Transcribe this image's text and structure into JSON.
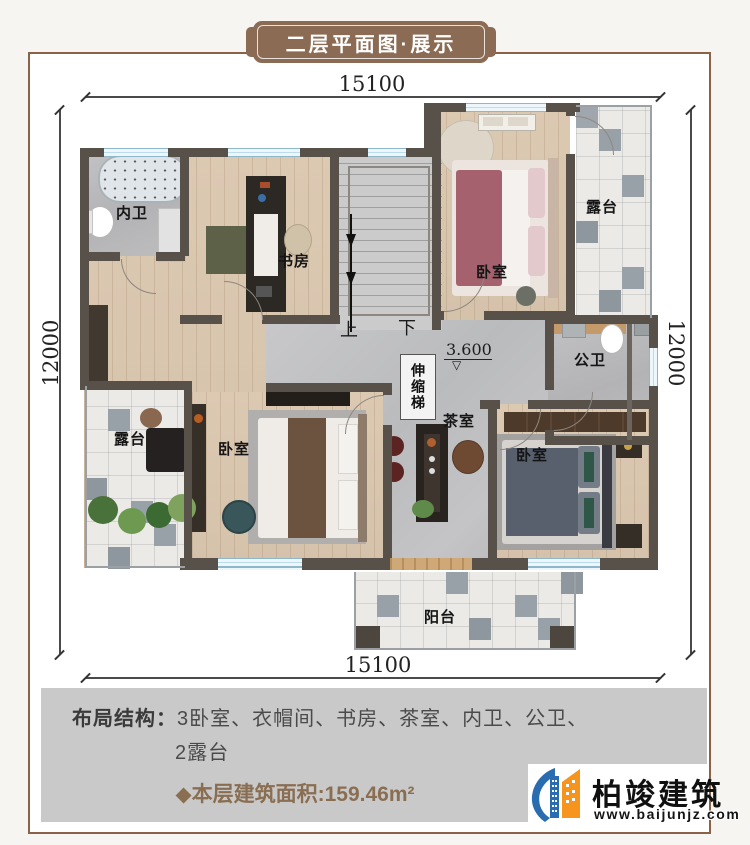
{
  "banner": {
    "title": "二层平面图·展示"
  },
  "dims": {
    "top": "15100",
    "bottom": "15100",
    "left": "12000",
    "right": "12000"
  },
  "plan": {
    "labels": {
      "neiwei": "内卫",
      "shufang": "书房",
      "bedroom_tr": "卧室",
      "terrace_tr": "露台",
      "gongwei": "公卫",
      "chashi": "茶室",
      "bedroom_bl": "卧室",
      "terrace_bl": "露台",
      "bedroom_br": "卧室",
      "balcony": "阳台",
      "up": "上",
      "down": "下",
      "elevation": "3.600",
      "elevation_mark": "▽",
      "ladder": "伸缩梯"
    }
  },
  "summary": {
    "layout_label": "布局结构：",
    "layout_line1": "3卧室、衣帽间、书房、茶室、内卫、公卫、",
    "layout_line2": "2露台",
    "area_text": "◆本层建筑面积:159.46m²"
  },
  "logo": {
    "name": "柏竣建筑",
    "website": "www.baijunjz.com"
  },
  "colors": {
    "frame": "#8a6248",
    "banner": "#8b6b53",
    "wall": "#57514a",
    "accent_brown": "#8a6e52",
    "panel_gray": "#c9c9c9",
    "logo_blue": "#2a6cb0",
    "logo_orange": "#f7941e"
  }
}
